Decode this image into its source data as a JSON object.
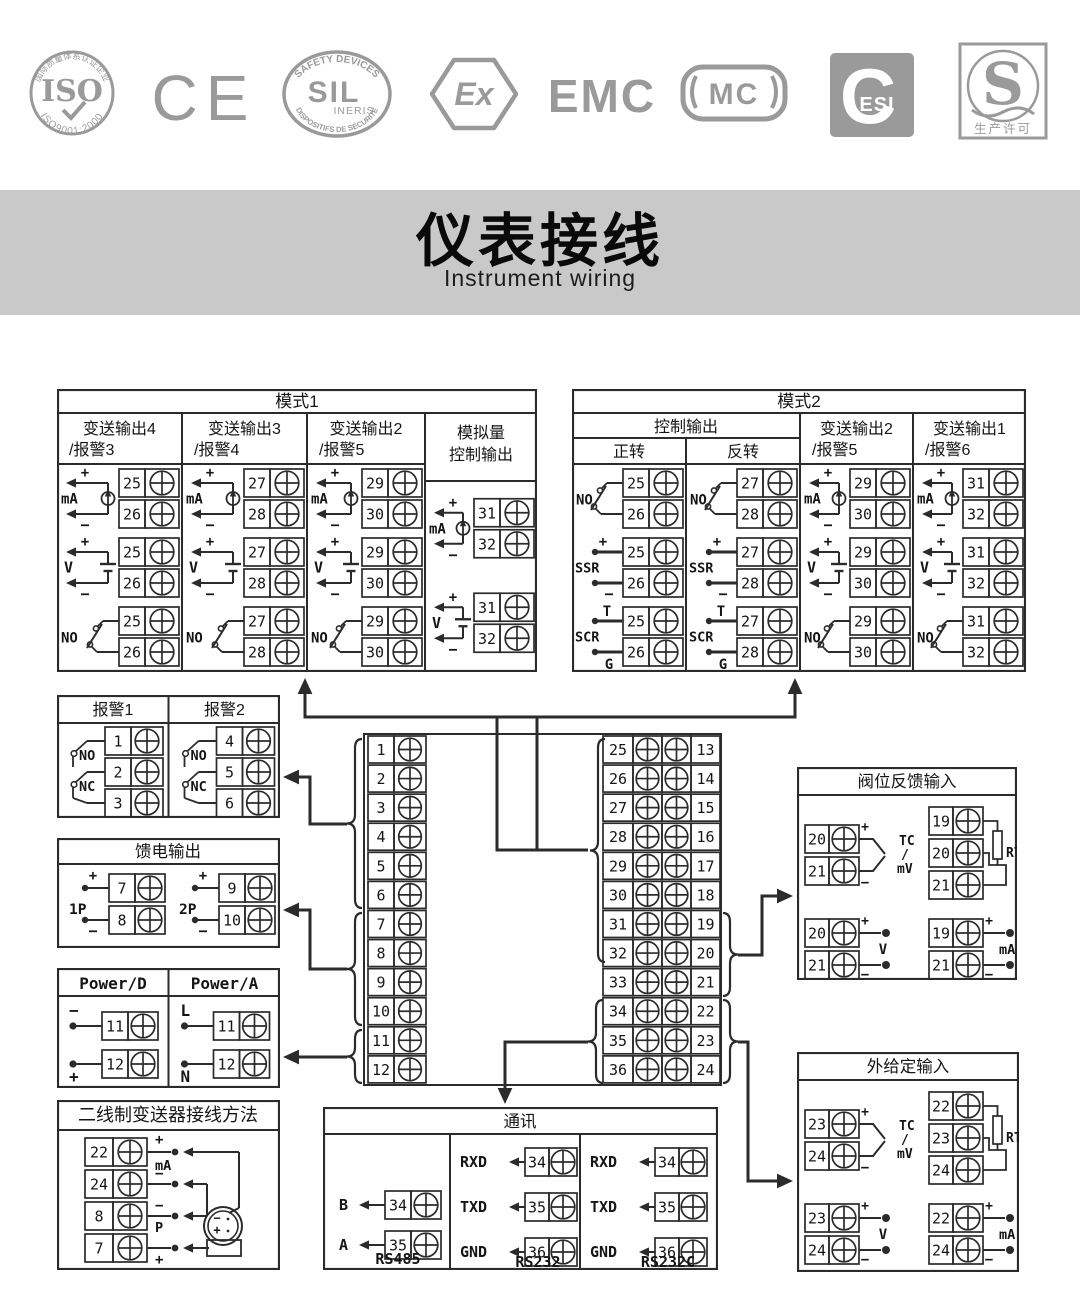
{
  "colors": {
    "line": "#2b2b2b",
    "logo_gray": "#9a9a9a",
    "banner_bg": "#c9c9c9",
    "text": "#111111"
  },
  "logos": {
    "iso": {
      "top_text": "国际质量体系认证企业",
      "main": "ISO",
      "bottom_text": "ISO9001:2000"
    },
    "ce": {
      "main": "CE"
    },
    "sil": {
      "top_text": "SAFETY DEVICES",
      "main": "SIL",
      "sub": "INERIS",
      "bottom_text": "DISPOSITIFS DE SÉCURITÉ"
    },
    "ex": {
      "main": "Ex"
    },
    "emc": {
      "main": "EMC"
    },
    "mc": {
      "main": "MC"
    },
    "cesi": {
      "main": "C",
      "sub": "ESI"
    },
    "s": {
      "main": "S",
      "bottom_text": "生产许可"
    }
  },
  "banner": {
    "title": "仪表接线",
    "subtitle": "Instrument wiring"
  },
  "mode1": {
    "title": "模式1",
    "columns": [
      {
        "header": [
          "变送输出4",
          "/报警3"
        ],
        "cells": [
          {
            "type": "mA",
            "t": [
              25,
              26
            ]
          },
          {
            "type": "V",
            "t": [
              25,
              26
            ]
          },
          {
            "type": "NO",
            "t": [
              25,
              26
            ]
          }
        ]
      },
      {
        "header": [
          "变送输出3",
          "/报警4"
        ],
        "cells": [
          {
            "type": "mA",
            "t": [
              27,
              28
            ]
          },
          {
            "type": "V",
            "t": [
              27,
              28
            ]
          },
          {
            "type": "NO",
            "t": [
              27,
              28
            ]
          }
        ]
      },
      {
        "header": [
          "变送输出2",
          "/报警5"
        ],
        "cells": [
          {
            "type": "mA",
            "t": [
              29,
              30
            ]
          },
          {
            "type": "V",
            "t": [
              29,
              30
            ]
          },
          {
            "type": "NO",
            "t": [
              29,
              30
            ]
          }
        ]
      },
      {
        "header": [
          "模拟量",
          "控制输出"
        ],
        "cells": [
          {
            "type": "mA",
            "t": [
              31,
              32
            ]
          },
          {
            "type": "V",
            "t": [
              31,
              32
            ]
          }
        ]
      }
    ]
  },
  "mode2": {
    "title": "模式2",
    "group_header": "控制输出",
    "columns": [
      {
        "header": [
          "正转"
        ],
        "cells": [
          {
            "type": "NO",
            "t": [
              25,
              26
            ]
          },
          {
            "type": "SSR",
            "t": [
              25,
              26
            ]
          },
          {
            "type": "SCR",
            "t": [
              25,
              26
            ]
          }
        ]
      },
      {
        "header": [
          "反转"
        ],
        "cells": [
          {
            "type": "NO",
            "t": [
              27,
              28
            ]
          },
          {
            "type": "SSR",
            "t": [
              27,
              28
            ]
          },
          {
            "type": "SCR",
            "t": [
              27,
              28
            ]
          }
        ]
      },
      {
        "header": [
          "变送输出2",
          "/报警5"
        ],
        "cells": [
          {
            "type": "mA",
            "t": [
              29,
              30
            ]
          },
          {
            "type": "V",
            "t": [
              29,
              30
            ]
          },
          {
            "type": "NO",
            "t": [
              29,
              30
            ]
          }
        ]
      },
      {
        "header": [
          "变送输出1",
          "/报警6"
        ],
        "cells": [
          {
            "type": "mA",
            "t": [
              31,
              32
            ]
          },
          {
            "type": "V",
            "t": [
              31,
              32
            ]
          },
          {
            "type": "NO",
            "t": [
              31,
              32
            ]
          }
        ]
      }
    ]
  },
  "alarm_box": {
    "columns": [
      {
        "header": "报警1",
        "contact_labels": [
          "NO",
          "NC"
        ],
        "t": [
          1,
          2,
          3
        ]
      },
      {
        "header": "报警2",
        "contact_labels": [
          "NO",
          "NC"
        ],
        "t": [
          4,
          5,
          6
        ]
      }
    ]
  },
  "feed_box": {
    "title": "馈电输出",
    "groups": [
      {
        "label": "1P",
        "t": [
          7,
          8
        ]
      },
      {
        "label": "2P",
        "t": [
          9,
          10
        ]
      }
    ]
  },
  "power_box": {
    "columns": [
      {
        "header": "Power/D",
        "rows": [
          {
            "sign": "−",
            "t": 11
          },
          {
            "sign": "+",
            "t": 12
          }
        ]
      },
      {
        "header": "Power/A",
        "rows": [
          {
            "sign": "L",
            "t": 11
          },
          {
            "sign": "N",
            "t": 12
          }
        ]
      }
    ]
  },
  "twowire_box": {
    "title": "二线制变送器接线方法",
    "rows": [
      {
        "t": 22,
        "sign": "+"
      },
      {
        "t": 24,
        "sign": "−"
      },
      {
        "t": 8,
        "sign": "−"
      },
      {
        "t": 7,
        "sign": "+"
      }
    ],
    "mid_labels": [
      "mA",
      "P"
    ],
    "device": {
      "minus": "−",
      "plus": "+"
    }
  },
  "strips": {
    "left": [
      1,
      2,
      3,
      4,
      5,
      6,
      7,
      8,
      9,
      10,
      11,
      12
    ],
    "right_inner": [
      25,
      26,
      27,
      28,
      29,
      30,
      31,
      32,
      33,
      34,
      35,
      36
    ],
    "right_outer": [
      13,
      14,
      15,
      16,
      17,
      18,
      19,
      20,
      21,
      22,
      23,
      24
    ]
  },
  "comm_box": {
    "title": "通讯",
    "groups": [
      {
        "label": "RS485",
        "lines": [
          {
            "sig": "B",
            "t": 34
          },
          {
            "sig": "A",
            "t": 35
          }
        ]
      },
      {
        "label": "RS232",
        "lines": [
          {
            "sig": "RXD",
            "t": 34
          },
          {
            "sig": "TXD",
            "t": 35
          },
          {
            "sig": "GND",
            "t": 36
          }
        ]
      },
      {
        "label": "RS232C",
        "lines": [
          {
            "sig": "RXD",
            "t": 34
          },
          {
            "sig": "TXD",
            "t": 35
          },
          {
            "sig": "GND",
            "t": 36
          }
        ]
      }
    ]
  },
  "valve_box": {
    "title": "阀位反馈输入",
    "tcmv": {
      "t": [
        20,
        21
      ],
      "label": [
        "TC",
        "/",
        "mV"
      ]
    },
    "rtd": {
      "t": [
        19,
        20,
        21
      ],
      "label": "RTD"
    },
    "v": {
      "t": [
        20,
        21
      ],
      "label": "V"
    },
    "ma": {
      "t": [
        19,
        21
      ],
      "label": "mA"
    }
  },
  "ext_box": {
    "title": "外给定输入",
    "tcmv": {
      "t": [
        23,
        24
      ],
      "label": [
        "TC",
        "/",
        "mV"
      ]
    },
    "rtd": {
      "t": [
        22,
        23,
        24
      ],
      "label": "RTD"
    },
    "v": {
      "t": [
        23,
        24
      ],
      "label": "V"
    },
    "ma": {
      "t": [
        22,
        24
      ],
      "label": "mA"
    }
  }
}
